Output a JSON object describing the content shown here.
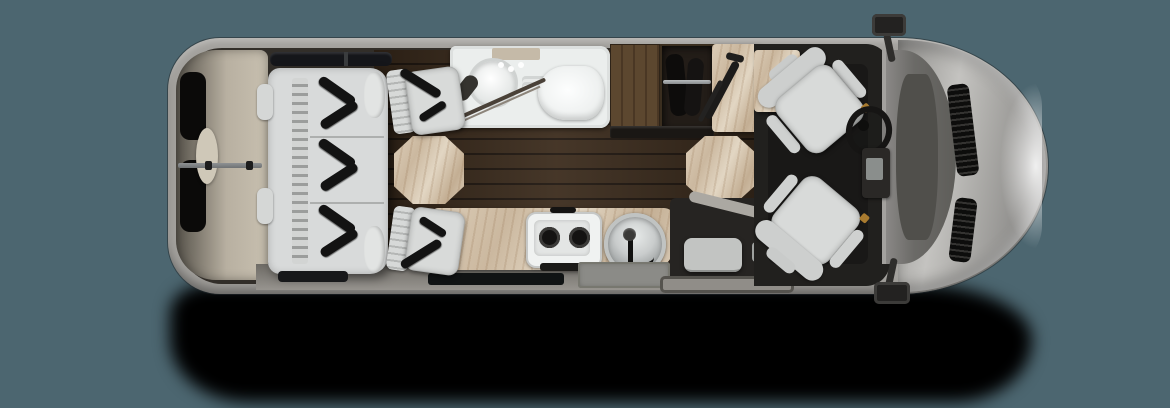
{
  "canvas": {
    "width": 1170,
    "height": 408,
    "background": "#4C6670"
  },
  "palette": {
    "background": "#4C6670",
    "drop_shadow": "#000000",
    "body_shell": "#A3A19D",
    "hood_silver": "#B5B4B1",
    "windshield": "#54534F",
    "interior_wall": "#322E29",
    "wood_floor": "#3C2C1D",
    "wood_gap": "#201710",
    "marble": "#D5C6B0",
    "marble_vein": "#B49A7E",
    "bathroom_pan": "#EBEEED",
    "fixture_white": "#F7F9F8",
    "sofa_upholstery": "#D8DADA",
    "seat_gray": "#D6D8D7",
    "seatbelt_black": "#131313",
    "cab_floor": "#21201E",
    "wardrobe_dark": "#231D18",
    "cabinet_wood": "#5C472F",
    "beige_trim": "#C4BCAD",
    "steel_rail": "#A8ABAD",
    "entry_step": "#C6C8C6",
    "window_glass": "#15161A",
    "belt_buckle_accent": "#A97B2F"
  },
  "floorplan": {
    "view": "top-down",
    "vehicle_type": "class-b-motorhome-floorplan",
    "orientation": "front-right",
    "zones": [
      {
        "name": "rear-storage",
        "features": [
          "rear-door-windows",
          "cargo-track-rail"
        ]
      },
      {
        "name": "rear-sofa",
        "seat_positions": 3,
        "seatbelts": 6
      },
      {
        "name": "dinette-seat-top",
        "seatbelts": 1
      },
      {
        "name": "dinette-seat-bottom",
        "seatbelts": 1
      },
      {
        "name": "dinette-table",
        "shape": "octagon",
        "material": "marble"
      },
      {
        "name": "wet-bath",
        "fixtures": [
          "round-sink",
          "faucet",
          "toilet",
          "shower-door"
        ]
      },
      {
        "name": "cabinet",
        "material": "wood"
      },
      {
        "name": "wardrobe",
        "features": [
          "hanging-rod",
          "garments"
        ]
      },
      {
        "name": "counter-with-grab-rail",
        "material": "marble"
      },
      {
        "name": "galley",
        "fixtures": [
          "two-burner-stove",
          "round-sink",
          "faucet"
        ],
        "stove_burners": 2
      },
      {
        "name": "entry-steps",
        "features": [
          "electric-step",
          "threshold-mat"
        ]
      },
      {
        "name": "front-table",
        "shape": "octagon",
        "material": "marble"
      },
      {
        "name": "cab",
        "fixtures": [
          "driver-swivel-seat",
          "passenger-swivel-seat",
          "steering-wheel",
          "center-console",
          "dashboard"
        ]
      },
      {
        "name": "hood",
        "features": [
          "vent-top",
          "vent-bottom"
        ]
      },
      {
        "name": "side-mirror-top"
      },
      {
        "name": "side-mirror-bottom"
      }
    ],
    "tables_count": 2,
    "swivel_seats_count": 2
  }
}
